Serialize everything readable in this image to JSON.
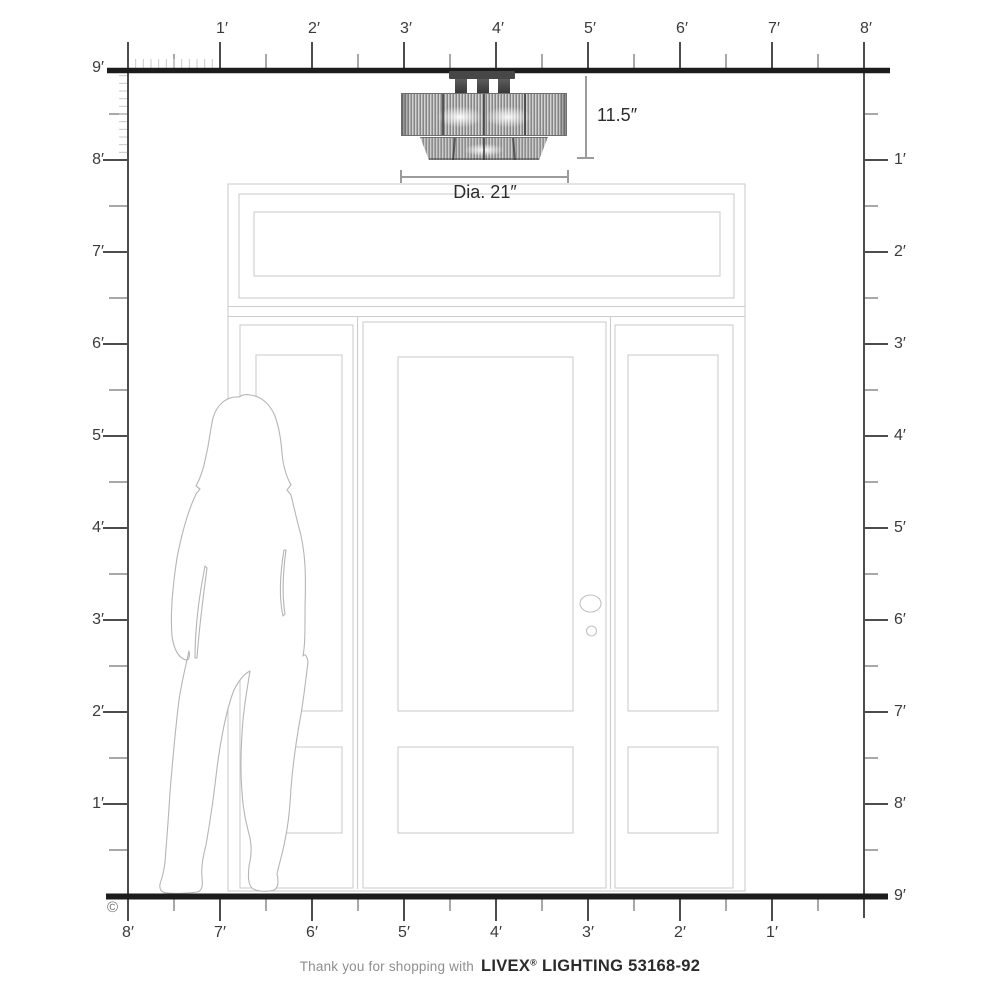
{
  "rulers": {
    "top_labels": [
      "1′",
      "2′",
      "3′",
      "4′",
      "5′",
      "6′",
      "7′",
      "8′"
    ],
    "left_labels": [
      "9′",
      "8′",
      "7′",
      "6′",
      "5′",
      "4′",
      "3′",
      "2′",
      "1′"
    ],
    "right_labels": [
      "1′",
      "2′",
      "3′",
      "4′",
      "5′",
      "6′",
      "7′",
      "8′",
      "9′"
    ],
    "bottom_labels": [
      "8′",
      "7′",
      "6′",
      "5′",
      "4′",
      "3′",
      "2′",
      "1′"
    ]
  },
  "fixture": {
    "height_label": "11.5″",
    "diameter_label": "Dia. 21″"
  },
  "footer": {
    "prefix": "Thank you for shopping with",
    "brand": "LIVEX",
    "registered": "®",
    "suffix": "LIGHTING 53168-92"
  },
  "copyright_symbol": "©",
  "colors": {
    "ruler_thick": "#1c1c1c",
    "tick_major": "#4d4d4d",
    "tick_half": "#8b8b8b",
    "tick_inch": "#c8c8c8",
    "door_line": "#cdcdcd",
    "silhouette_line": "#b5b5b5",
    "dimension_line": "#9b9b9b",
    "label_text": "#3b3b3b"
  }
}
